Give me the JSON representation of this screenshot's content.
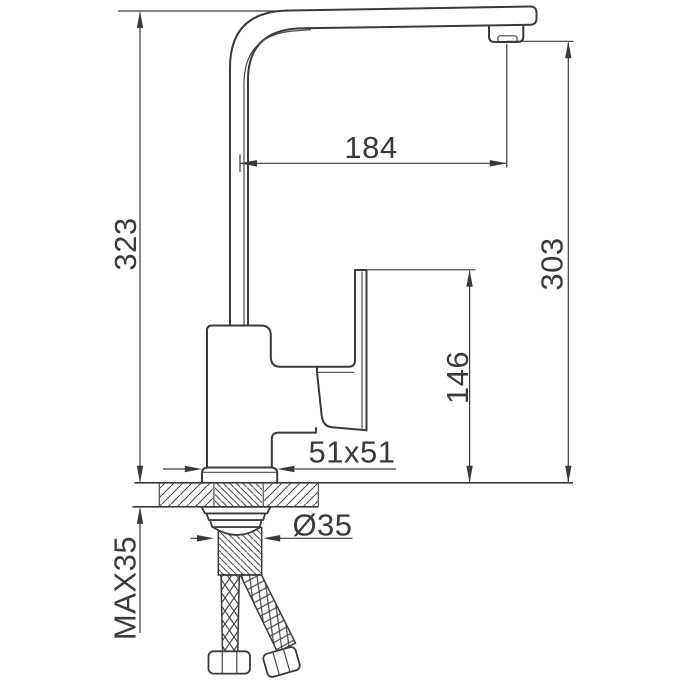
{
  "drawing": {
    "subject": "kitchen-faucet-installation-dimension-drawing-side-view",
    "units": "mm",
    "background_color": "#ffffff",
    "line_color": "#3a3a3a",
    "labels": {
      "spout_reach": "184",
      "overall_height": "323",
      "outlet_height": "303",
      "handle_top_height": "146",
      "base_plate_size": "51x51",
      "mounting_hole_diameter": "Ø35",
      "max_deck_thickness": "MAX35"
    }
  }
}
